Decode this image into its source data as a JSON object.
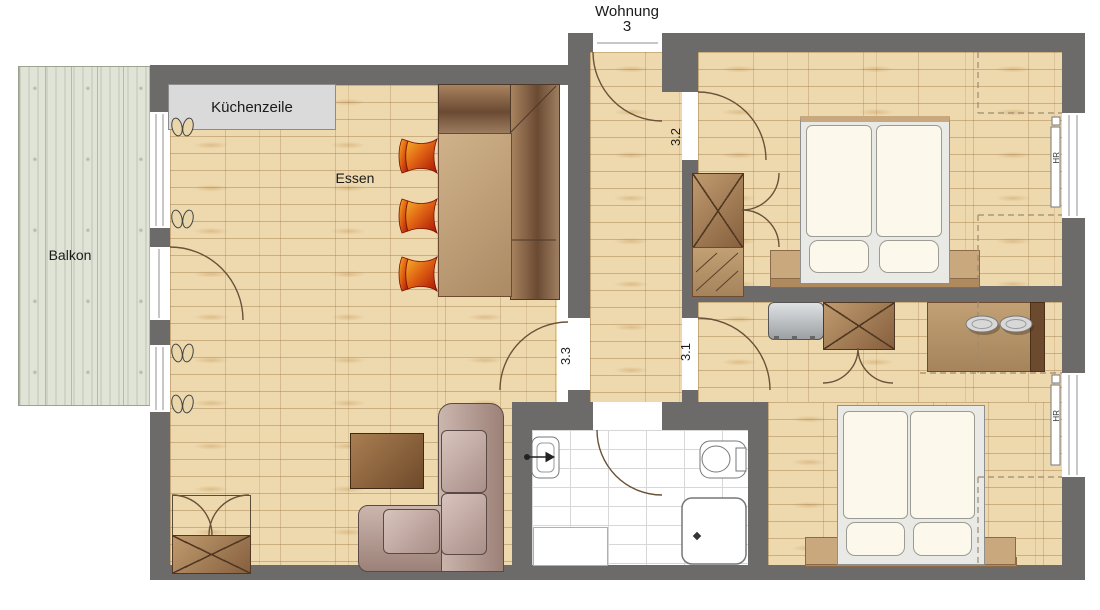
{
  "title": {
    "line1": "Wohnung",
    "line2": "3"
  },
  "rooms": {
    "balcony": "Balkon",
    "kitchen": "Küchenzeile",
    "dining": "Essen"
  },
  "door_numbers": {
    "top_bedroom": "3.2",
    "living_room": "3.3",
    "bottom_bedroom": "3.1"
  },
  "radiators": {
    "top": "HR",
    "bottom": "HR"
  },
  "colors": {
    "wall": "#6c6b6a",
    "wood_floor": "#eed9af",
    "plank_line": "#b98f58",
    "balcony_deck": "#e0e4d7",
    "kitchen_unit": "#dadada",
    "bench_wood": "#6b4a33",
    "table_wood": "#c1a37c",
    "chair_orange": "#f6b32a",
    "chair_red": "#a81505",
    "sofa_mauve": "#b49a92",
    "wardrobe_wood": "#a37c50",
    "bed_linen": "#fcf8ec",
    "nightstand": "#c9a87e",
    "bathroom_tile": "#ffffff",
    "appliance_gray": "#c2c6c9"
  }
}
